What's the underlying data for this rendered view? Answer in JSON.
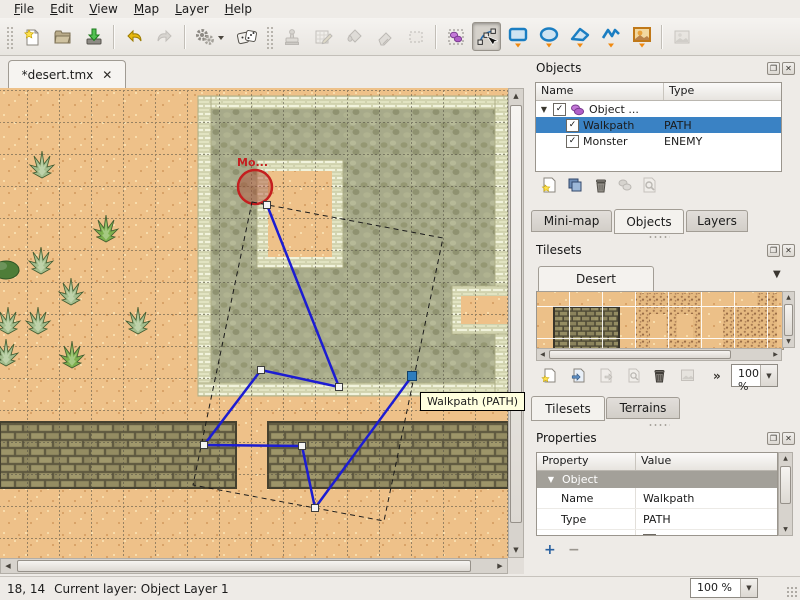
{
  "menu": {
    "items": [
      "File",
      "Edit",
      "View",
      "Map",
      "Layer",
      "Help"
    ]
  },
  "toolbar": {
    "buttons": [
      "new",
      "open",
      "save",
      "undo",
      "redo",
      "tool-presets",
      "random-mode",
      "stamp-brush",
      "terrain-brush",
      "bucket-fill",
      "eraser",
      "rectangular-select",
      "select-objects",
      "edit-polygons",
      "insert-rectangle",
      "insert-ellipse",
      "insert-polygon",
      "insert-polyline",
      "insert-tile-object",
      "map-image"
    ]
  },
  "document_tab": {
    "title": "*desert.tmx"
  },
  "ui": {
    "close_glyph": "✕",
    "check_glyph": "✓",
    "expander_glyph": "▼",
    "dropdown_glyph": "▼",
    "overflow_glyph": "»",
    "up_glyph": "▲",
    "down_glyph": "▼",
    "left_glyph": "◀",
    "right_glyph": "▶",
    "plus_glyph": "+",
    "minus_glyph": "−",
    "float_glyph": "❐"
  },
  "map_canvas": {
    "tooltip": "Walkpath (PATH)",
    "monster_label": "Mo...",
    "monster_label_pos": {
      "x": 237,
      "y": 166
    },
    "monster_ellipse": {
      "cx": 255,
      "cy": 187,
      "r": 17
    },
    "walkpath_points": [
      [
        267,
        205
      ],
      [
        339,
        387
      ],
      [
        261,
        370
      ],
      [
        204,
        445
      ],
      [
        302,
        446
      ],
      [
        315,
        508
      ],
      [
        412,
        376
      ]
    ],
    "selected_point_index": 6,
    "selection_outline": [
      [
        252,
        202
      ],
      [
        443,
        238
      ],
      [
        384,
        521
      ],
      [
        193,
        485
      ]
    ],
    "cacti": [
      {
        "x": 26,
        "y": 148,
        "variant": "pale"
      },
      {
        "x": 90,
        "y": 212,
        "variant": "bright"
      },
      {
        "x": 25,
        "y": 244,
        "variant": "pale"
      },
      {
        "x": -10,
        "y": 250,
        "variant": "dark"
      },
      {
        "x": 55,
        "y": 275,
        "variant": "pale"
      },
      {
        "x": -8,
        "y": 304,
        "variant": "pale"
      },
      {
        "x": 22,
        "y": 304,
        "variant": "pale"
      },
      {
        "x": 122,
        "y": 304,
        "variant": "pale"
      },
      {
        "x": -10,
        "y": 336,
        "variant": "pale"
      },
      {
        "x": 56,
        "y": 338,
        "variant": "bright"
      }
    ],
    "cactus_colors": {
      "pale": "#a3bd8d",
      "bright": "#7db04e",
      "dark": "#4e7d38"
    },
    "colors": {
      "path": "#1c1cd2",
      "selection_dash": "#1a1a1a",
      "monster": "#c41f1f",
      "handle_fill": "#f4f4f4",
      "handle_stroke": "#3c3c3c",
      "selected_handle_fill": "#2e7dbd",
      "selected_handle_stroke": "#123f66"
    }
  },
  "objects_panel": {
    "title": "Objects",
    "columns": [
      "Name",
      "Type"
    ],
    "rows": [
      {
        "name": "Object ...",
        "type": "",
        "checked": true,
        "expanded": true,
        "kind": "group"
      },
      {
        "name": "Walkpath",
        "type": "PATH",
        "checked": true,
        "selected": true
      },
      {
        "name": "Monster",
        "type": "ENEMY",
        "checked": true
      }
    ],
    "toolbar": [
      "new-object-layer",
      "duplicate-objects",
      "remove-objects",
      "object-properties",
      "goto-object"
    ]
  },
  "dock_tabs": {
    "items": [
      "Mini-map",
      "Objects",
      "Layers"
    ],
    "active": "Objects"
  },
  "tilesets_panel": {
    "title": "Tilesets",
    "tileset_name": "Desert",
    "zoom_value": "100 %",
    "toolbar": [
      "new-tileset",
      "import-tileset",
      "export-tileset",
      "tileset-properties",
      "remove-tileset",
      "edit-tileset"
    ]
  },
  "bottom_tabs": {
    "items": [
      "Tilesets",
      "Terrains"
    ],
    "active": "Tilesets"
  },
  "properties_panel": {
    "title": "Properties",
    "columns": [
      "Property",
      "Value"
    ],
    "group_label": "Object",
    "rows": [
      {
        "property": "Name",
        "value": "Walkpath"
      },
      {
        "property": "Type",
        "value": "PATH"
      },
      {
        "property": "Visible",
        "value": "checked"
      }
    ]
  },
  "status_bar": {
    "coordinates": "18, 14",
    "current_layer": "Current layer: Object Layer 1",
    "zoom_value": "100 %"
  }
}
